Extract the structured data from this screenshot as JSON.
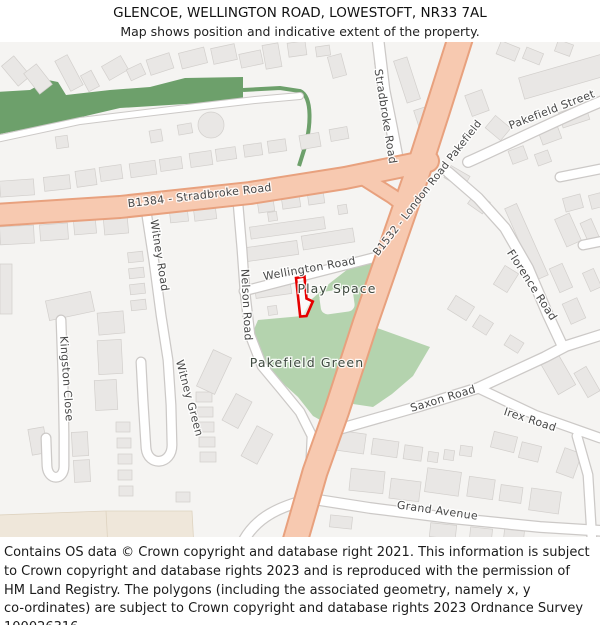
{
  "header": {
    "title": "GLENCOE, WELLINGTON ROAD, LOWESTOFT, NR33 7AL",
    "subtitle": "Map shows position and indicative extent of the property."
  },
  "map": {
    "road_labels": {
      "b1384": "B1384 - Stradbroke Road",
      "b1532": "B1532 - London Road Pakefield",
      "stradbroke": "Stradbroke Road",
      "pakefield_street": "Pakefield Street",
      "wellington": "Wellington Road",
      "nelson": "Nelson Road",
      "witney_road": "Witney Road",
      "witney_green": "Witney Green",
      "kingston": "Kingston Close",
      "florence": "Florence Road",
      "saxon": "Saxon Road",
      "irex": "Irex Road",
      "grand": "Grand Avenue"
    },
    "area_labels": {
      "play_space": "Play Space",
      "pakefield_green": "Pakefield Green"
    },
    "colors": {
      "map_background": "#f5f4f2",
      "building_fill": "#e9e7e5",
      "primary_road_fill": "#f7c9b0",
      "primary_road_casing": "#e8a17e",
      "minor_road_casing": "#ccc9c7",
      "green_area": "#b4d3ae",
      "tree_belt": "#6da06b",
      "beige_area": "#efe7da",
      "property_outline": "#e60000",
      "label_color": "#474747"
    }
  },
  "footer": {
    "lines": [
      "Contains OS data © Crown copyright and database right 2021. This information is subject",
      "to Crown copyright and database rights 2023 and is reproduced with the permission of",
      "HM Land Registry. The polygons (including the associated geometry, namely x, y",
      "co-ordinates) are subject to Crown copyright and database rights 2023 Ordnance Survey",
      "100026316."
    ]
  }
}
